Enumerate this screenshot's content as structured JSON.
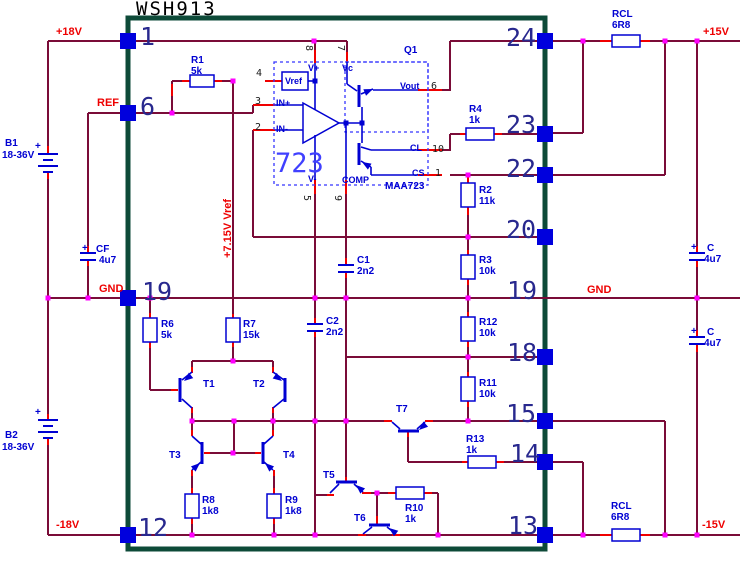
{
  "title": "WSH913",
  "pins": {
    "left": [
      "1",
      "6",
      "19",
      "12"
    ],
    "right": [
      "24",
      "23",
      "22",
      "20",
      "19",
      "18",
      "15",
      "14",
      "13"
    ]
  },
  "rails": {
    "p18v": "+18V",
    "ref": "REF",
    "gnd_left": "GND",
    "n18v": "-18V",
    "p15v": "+15V",
    "n15v": "-15V",
    "gnd_right": "GND",
    "vref_rail": "+7.15V Vref"
  },
  "batteries": {
    "b1": {
      "name": "B1",
      "value": "18-36V"
    },
    "b2": {
      "name": "B2",
      "value": "18-36V"
    }
  },
  "resistors": {
    "r1": {
      "name": "R1",
      "value": "5k"
    },
    "r2": {
      "name": "R2",
      "value": "11k"
    },
    "r3": {
      "name": "R3",
      "value": "10k"
    },
    "r4": {
      "name": "R4",
      "value": "1k"
    },
    "r6": {
      "name": "R6",
      "value": "5k"
    },
    "r7": {
      "name": "R7",
      "value": "15k"
    },
    "r8": {
      "name": "R8",
      "value": "1k8"
    },
    "r9": {
      "name": "R9",
      "value": "1k8"
    },
    "r10": {
      "name": "R10",
      "value": "1k"
    },
    "r11": {
      "name": "R11",
      "value": "10k"
    },
    "r12": {
      "name": "R12",
      "value": "10k"
    },
    "r13": {
      "name": "R13",
      "value": "1k"
    },
    "rcl_top": {
      "name": "RCL",
      "value": "6R8"
    },
    "rcl_bottom": {
      "name": "RCL",
      "value": "6R8"
    }
  },
  "capacitors": {
    "c1": {
      "name": "C1",
      "value": "2n2"
    },
    "c2": {
      "name": "C2",
      "value": "2n2"
    },
    "cf": {
      "name": "CF",
      "value": "4u7"
    },
    "c_top": {
      "name": "C",
      "value": "4u7"
    },
    "c_bottom": {
      "name": "C",
      "value": "4u7"
    },
    "plus": "+"
  },
  "transistors": {
    "t1": "T1",
    "t2": "T2",
    "t3": "T3",
    "t4": "T4",
    "t5": "T5",
    "t6": "T6",
    "t7": "T7",
    "q1": "Q1"
  },
  "ic": {
    "label": "723",
    "part": "MAA723",
    "pins": {
      "vref": "Vref",
      "vplus": "V+",
      "vc": "Vc",
      "inp": "IN+",
      "inn": "IN-",
      "vminus": "V-",
      "comp": "COMP",
      "vout": "Vout",
      "cl": "CL",
      "cs": "CS"
    },
    "nums": {
      "n1": "1",
      "n2": "2",
      "n3": "3",
      "n4": "4",
      "n5": "5",
      "n6": "6",
      "n7": "7",
      "n8": "8",
      "n9": "9",
      "n10": "10"
    }
  },
  "colors": {
    "wire": "#7a0c38",
    "pin_red": "#f00000",
    "component": "#0000d2",
    "dashed": "#3535ff",
    "pin_square": "#0000dd",
    "border": "#0d4a38",
    "junction": "#ff00ff",
    "label_red": "#ee0000",
    "pin_number": "#28288e"
  }
}
